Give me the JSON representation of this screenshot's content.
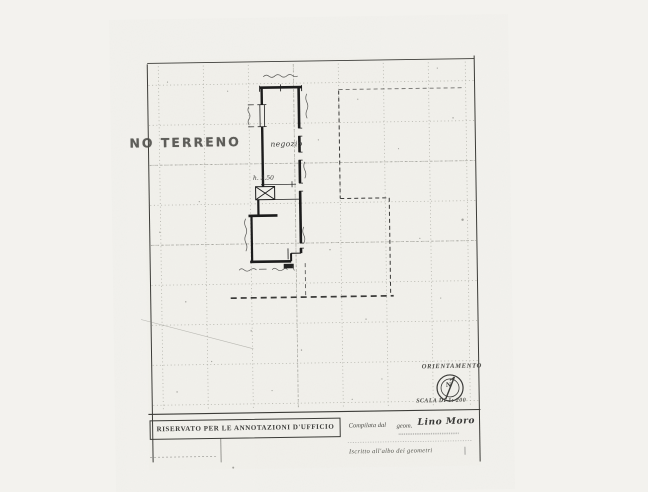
{
  "page": {
    "paper_color": "#f3f2ee",
    "ink_color": "#1c1c1c",
    "grid_color": "#a8a89f"
  },
  "plan": {
    "floor_label": "NO TERRENO",
    "room_label": "negozio",
    "height_note": "h. 3.50"
  },
  "orientation": {
    "title": "ORIENTAMENTO",
    "north": "N",
    "scale": "SCALA DI 1: 200"
  },
  "footer": {
    "office_box": "RISERVATO PER LE ANNOTAZIONI D'UFFICIO",
    "compiled_by_prefix": "Compilata dal",
    "compiled_by_title": "geom.",
    "compiler_name": "Lino Moro",
    "registration_note": "Iscritto all'albo dei geometri"
  }
}
